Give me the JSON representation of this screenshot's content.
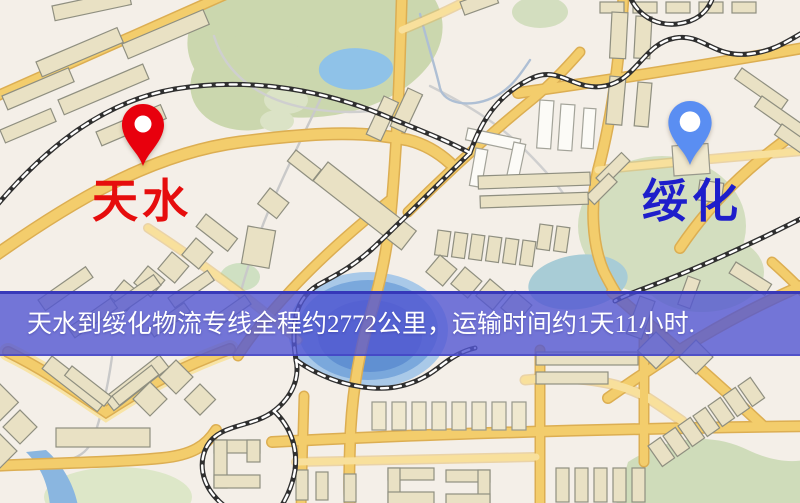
{
  "map": {
    "origin_marker": {
      "label": "天水",
      "pin_color": "#e8000d",
      "label_color": "#e60d0d"
    },
    "destination_marker": {
      "label": "绥化",
      "pin_color": "#5a8ef2",
      "label_color": "#1e1ecb"
    }
  },
  "banner": {
    "text": "天水到绥化物流专线全程约2772公里，运输时间约1天11小时.",
    "overlay_rgba": "rgba(83,86,210,0.8)",
    "text_color": "#ffffff",
    "route_summary": {
      "origin": "天水",
      "destination": "绥化",
      "distance_km": "2772",
      "transit_time": "1天11小时"
    }
  }
}
